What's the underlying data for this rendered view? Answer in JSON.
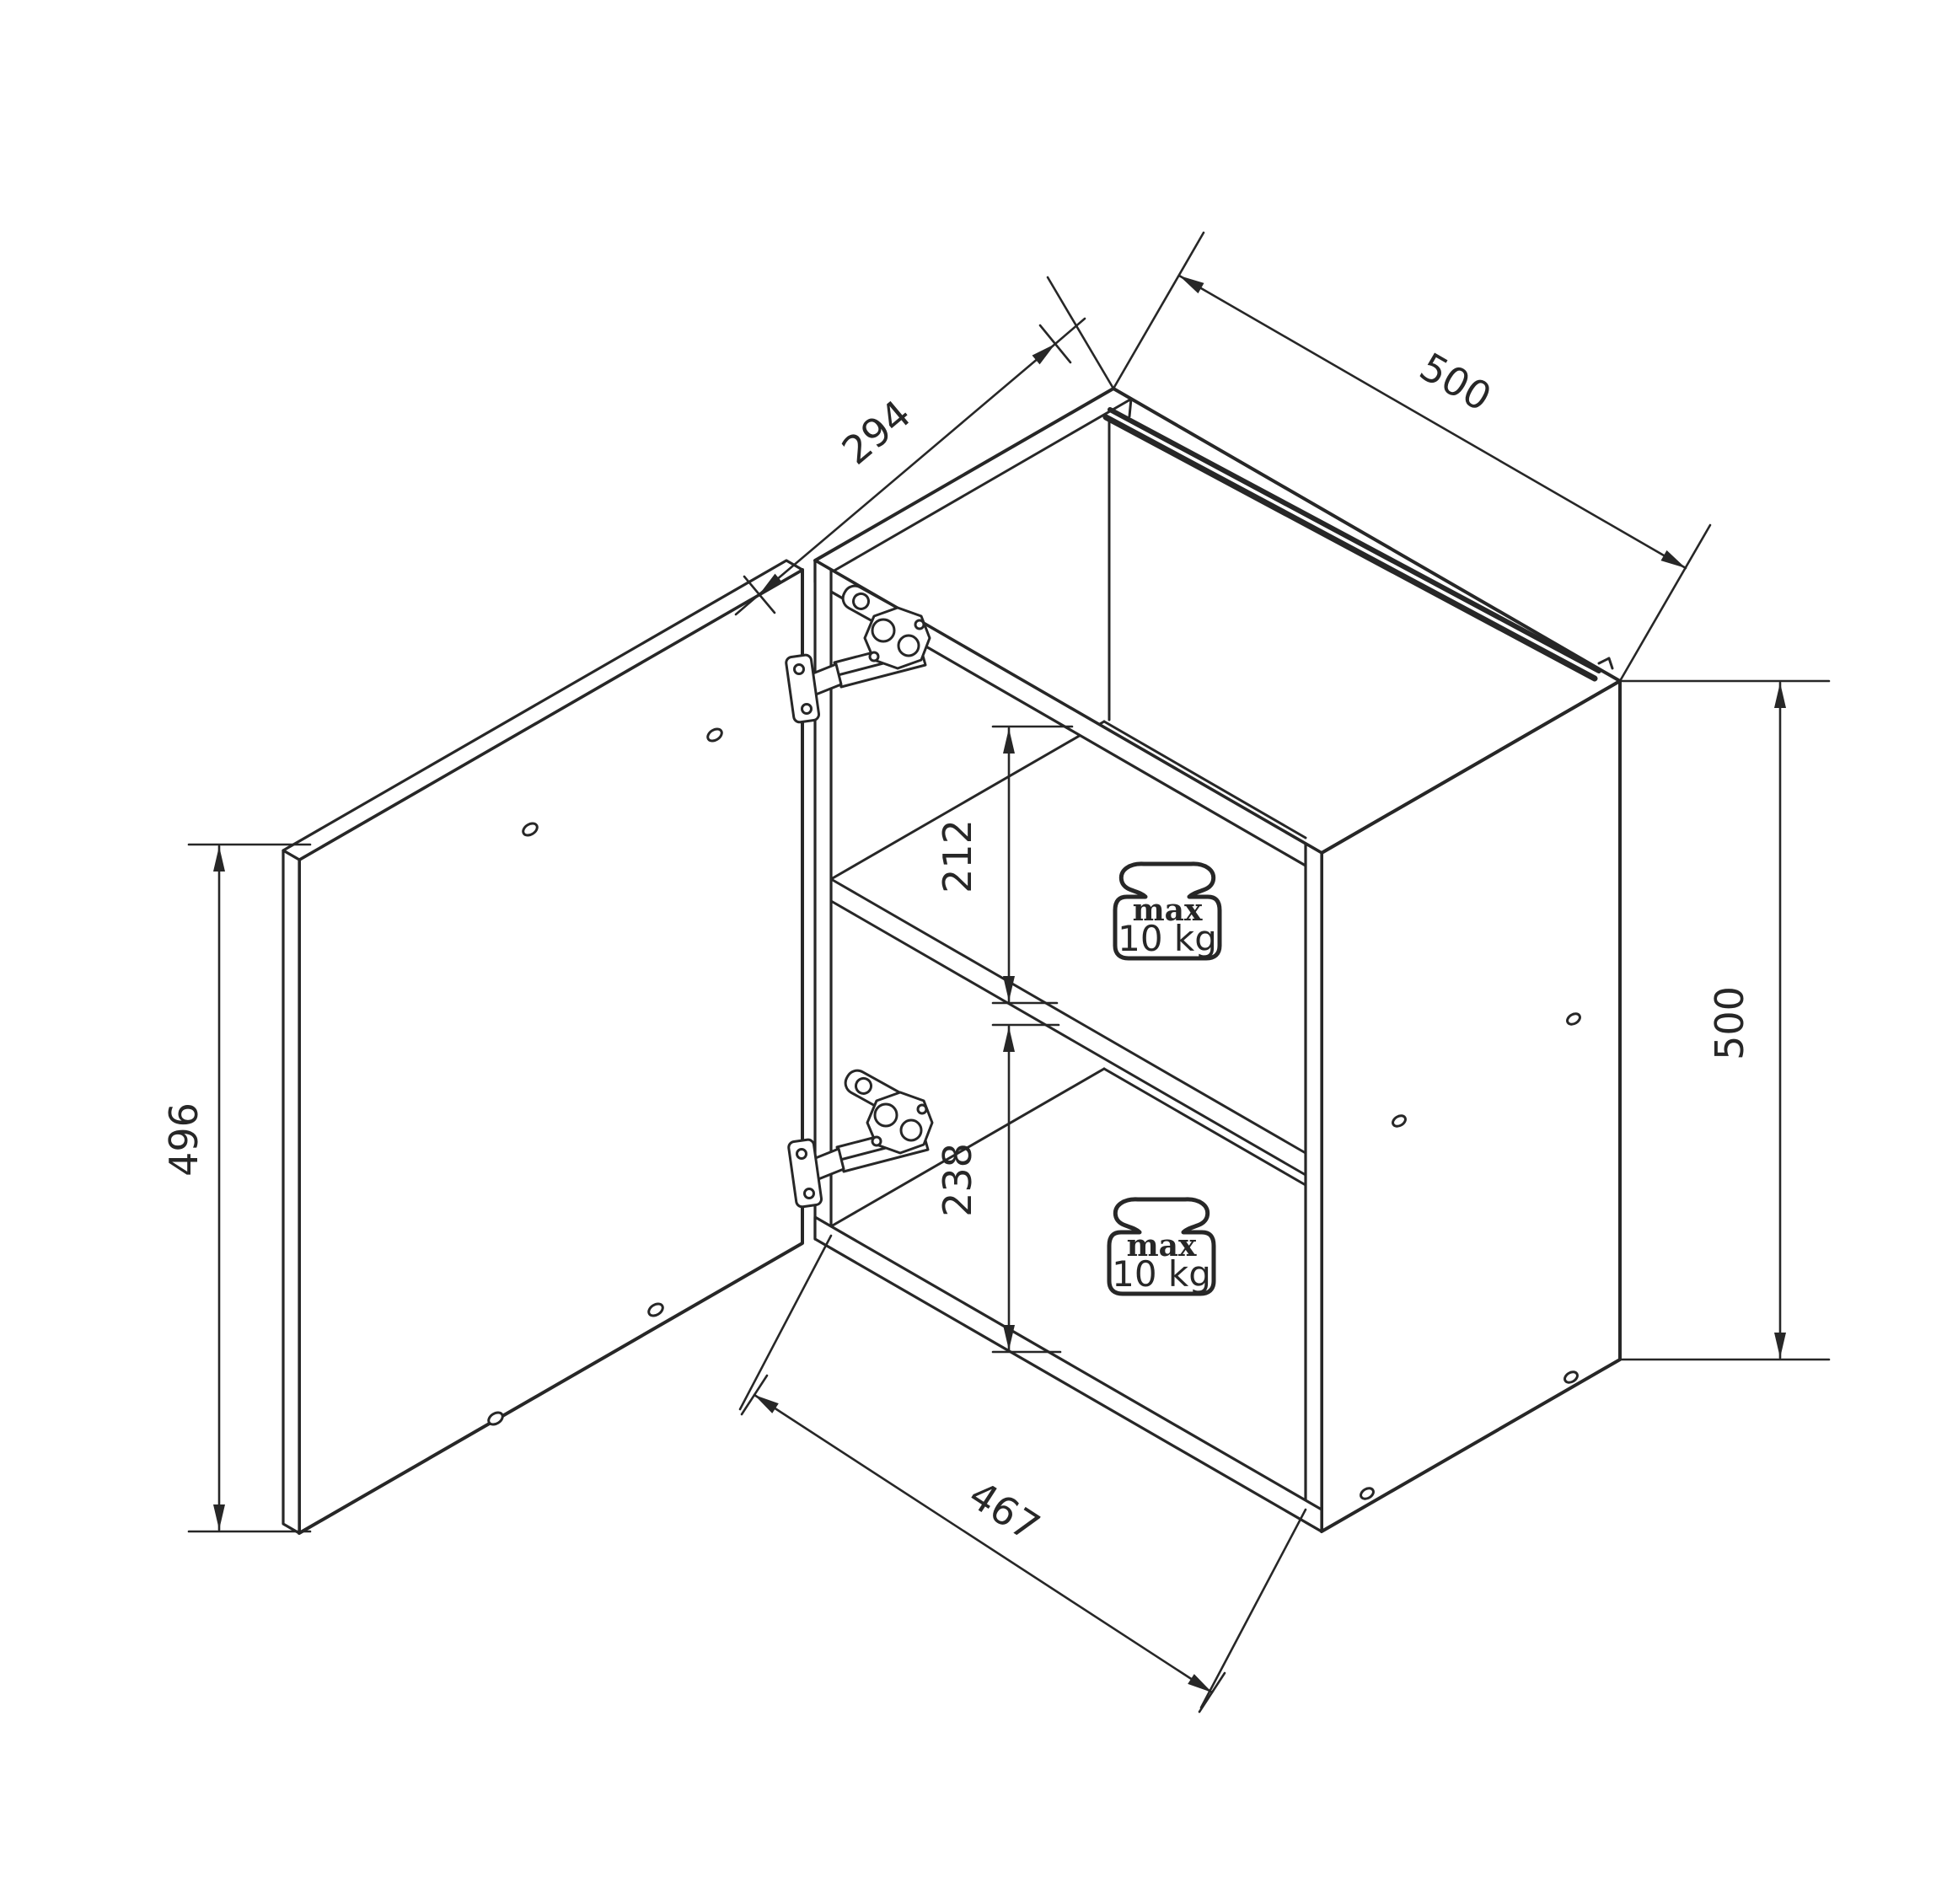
{
  "drawing": {
    "type": "technical-assembly-diagram",
    "subject": "wall cabinet with open left door, two shelves, two concealed hinges",
    "background": "#ffffff",
    "line_color": "#272727",
    "dimensions": {
      "depth_294": "294",
      "top_width_500": "500",
      "door_height_496": "496",
      "side_height_500": "500",
      "upper_shelf_space_212": "212",
      "lower_shelf_space_238": "238",
      "interior_width_467": "467"
    },
    "load_labels": [
      {
        "line1": "max",
        "line2": "10 kg"
      },
      {
        "line1": "max",
        "line2": "10 kg"
      }
    ]
  }
}
